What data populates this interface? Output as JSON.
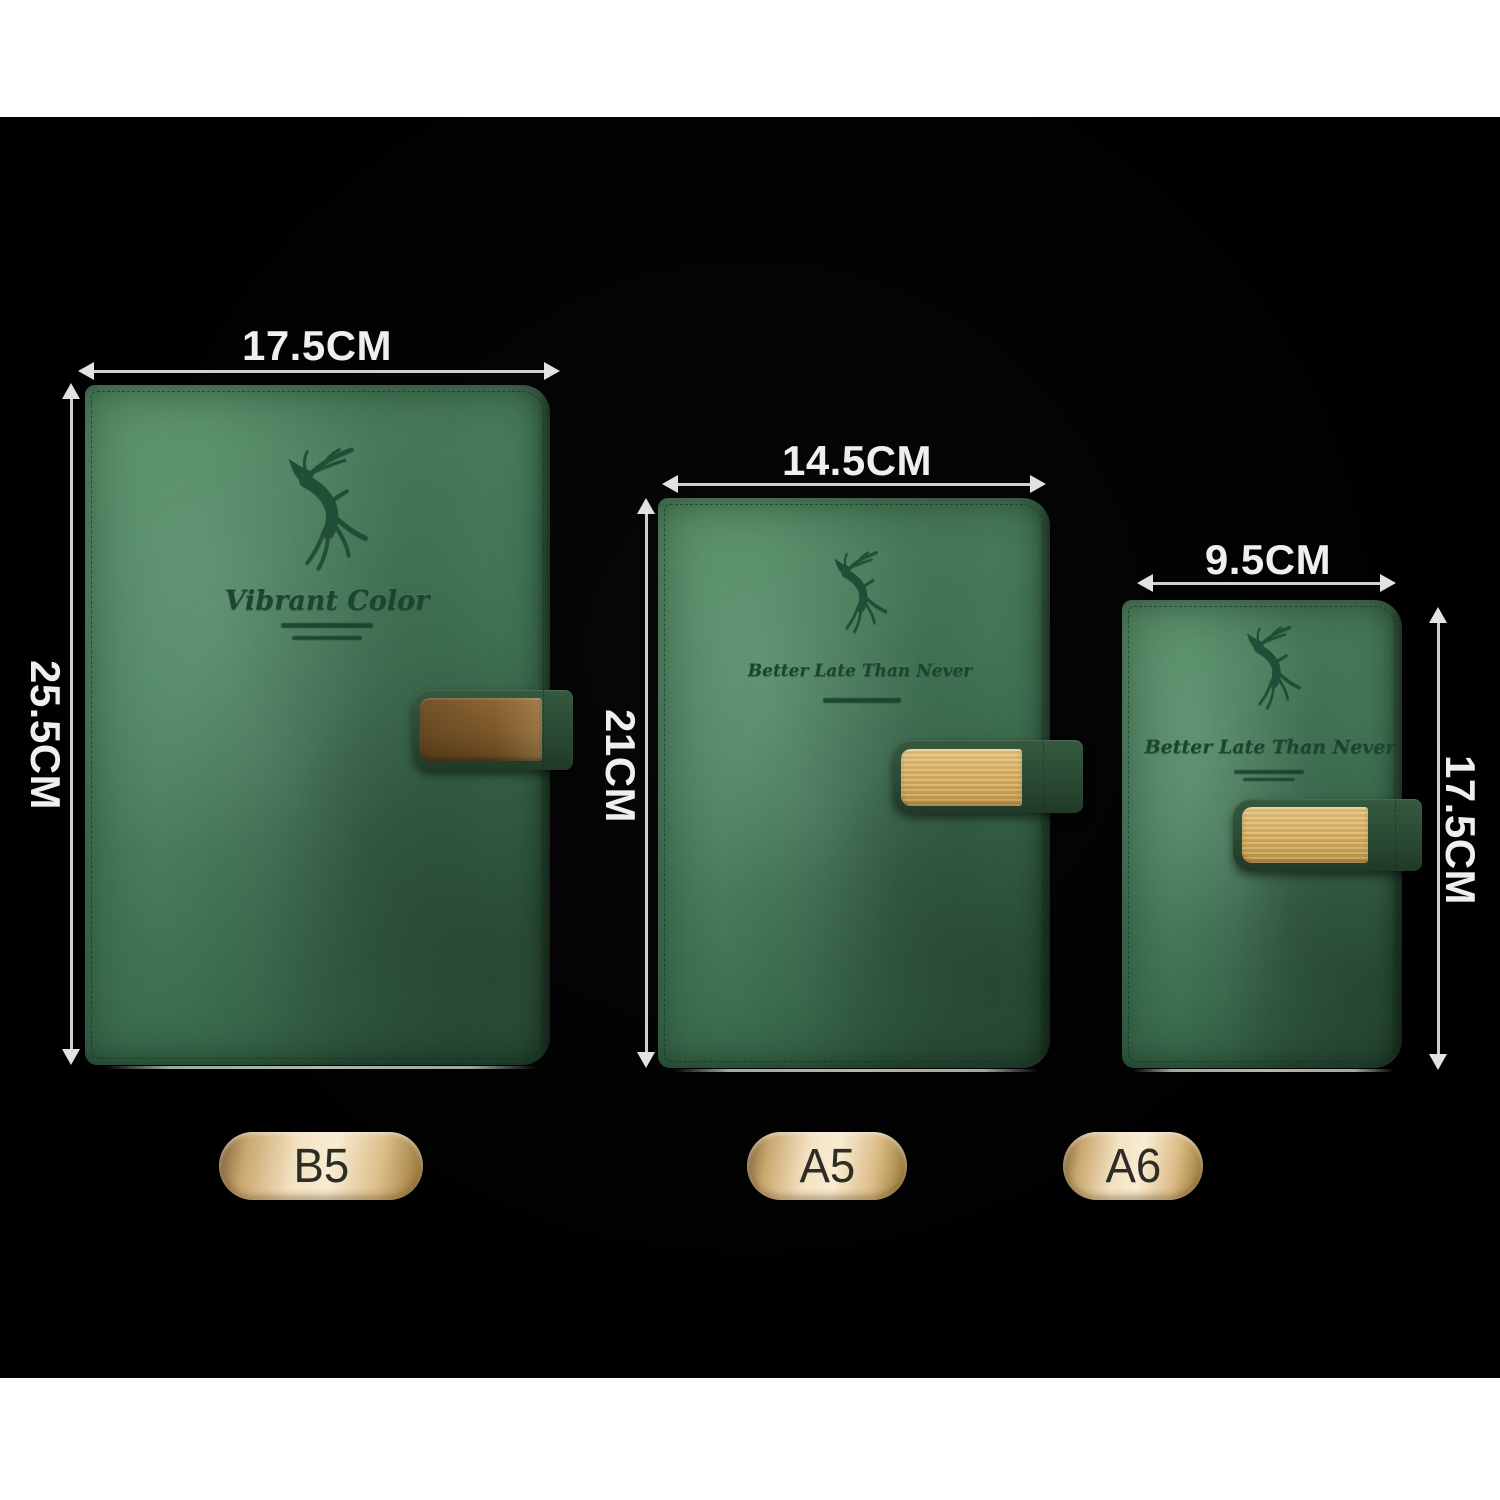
{
  "products": [
    {
      "label": "B5",
      "width_label": "17.5CM",
      "height_label": "25.5CM",
      "cover_script": "Vibrant Color"
    },
    {
      "label": "A5",
      "width_label": "14.5CM",
      "height_label": "21CM",
      "cover_script": "Better Late Than Never"
    },
    {
      "label": "A6",
      "width_label": "9.5CM",
      "height_label": "17.5CM",
      "cover_script": "Better Late Than Never"
    }
  ],
  "icons": {
    "logo": "deer-logo"
  },
  "colors": {
    "stage_background": "#000000",
    "page_background": "#ffffff",
    "cover_green": "#4a8360",
    "engraving_green": "#1c4530",
    "strap_green": "#2a4a33",
    "clasp_brown": "#7b5728",
    "clasp_gold": "#d4ab58",
    "pill_gold_light": "#f3e2c2",
    "pill_gold_dark": "#93712e",
    "pill_text": "#2d2d26",
    "dimension_text": "#efefef",
    "dimension_line": "#cfcfcf"
  }
}
